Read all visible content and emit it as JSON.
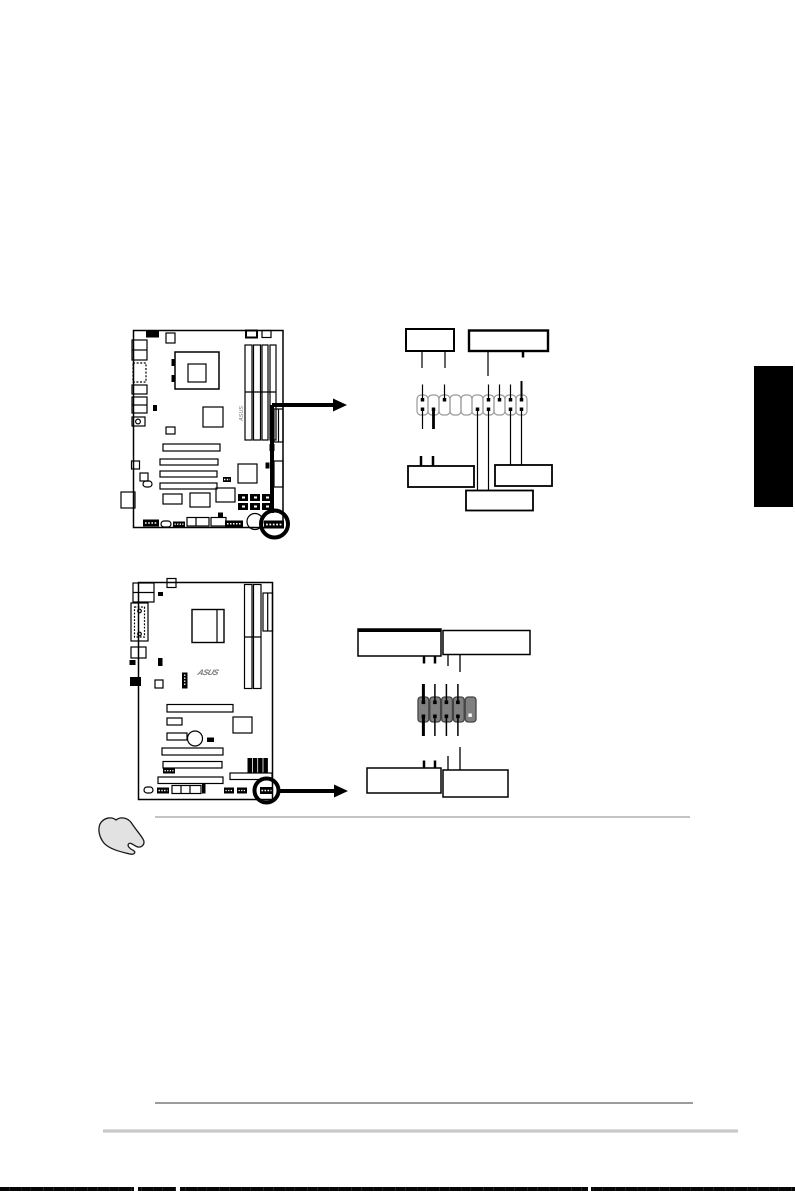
{
  "page": {
    "background": "#ffffff"
  },
  "colors": {
    "ink": "#000000",
    "pin_cell_outline": "#999999",
    "connector_gray": "#808080",
    "hand_fill": "#e2e2e2",
    "chapter_tab": "#000000",
    "note_rule": "#8a8a8a",
    "footer_rule_dark": "#7a7a7a",
    "footer_rule_light": "#c9c9c9",
    "scan_bar": "#060606"
  },
  "logos": {
    "board_top": "ASUS",
    "board_bottom": "ASUS"
  },
  "icons": {
    "note": "pointing-hand-icon",
    "callout": "arrow-right-icon"
  }
}
